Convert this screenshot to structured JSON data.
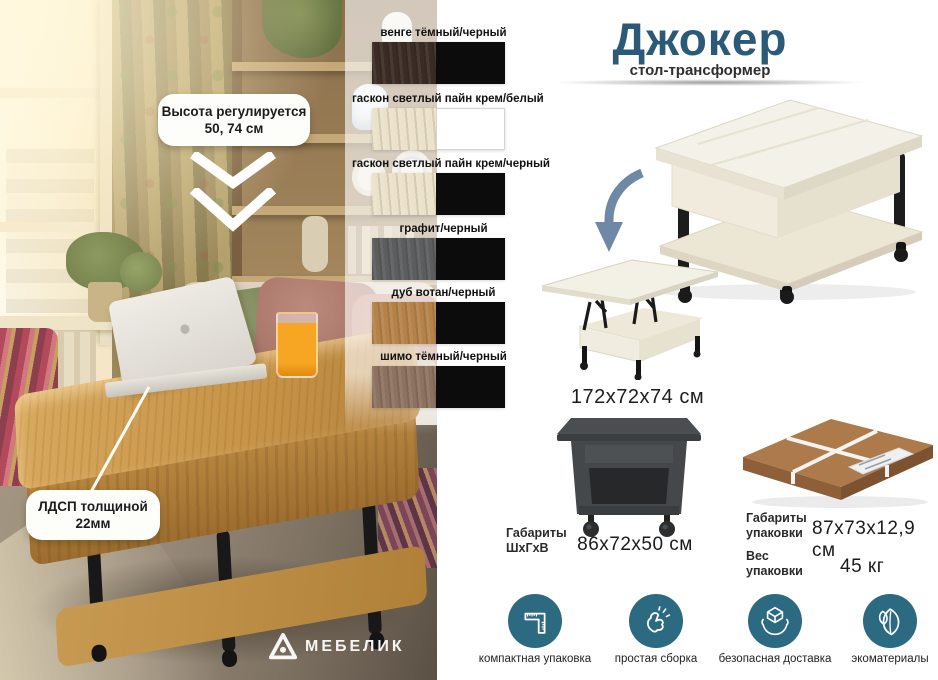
{
  "colors": {
    "accent": "#2b5a78",
    "icon_teal": "#2c6a82"
  },
  "photo": {
    "callout_height_line1": "Высота регулируется",
    "callout_height_line2": "50, 74 см",
    "callout_ldsp_line1": "ЛДСП толщиной",
    "callout_ldsp_line2": "22мм",
    "brand": "МЕБЕЛИК"
  },
  "swatches": [
    {
      "label": "венге тёмный/черный",
      "tex": "#3a2c24",
      "solid": "#0c0c0c"
    },
    {
      "label": "гаскон светлый пайн крем/белый",
      "tex": "#ece2c9",
      "solid": "#ffffff"
    },
    {
      "label": "гаскон светлый пайн крем/черный",
      "tex": "#ece2c9",
      "solid": "#0c0c0c"
    },
    {
      "label": "графит/черный",
      "tex": "#5b5d5f",
      "solid": "#0c0c0c"
    },
    {
      "label": "дуб вотан/черный",
      "tex": "#b5834a",
      "solid": "#0c0c0c"
    },
    {
      "label": "шимо тёмный/черный",
      "tex": "#8d7260",
      "solid": "#0c0c0c"
    }
  ],
  "header": {
    "title": "Джокер",
    "subtitle": "стол-трансформер"
  },
  "product": {
    "open_size": "172х72х74 см",
    "dims_label1": "Габариты",
    "dims_label2": "ШхГхВ",
    "dims_value": "86х72х50 см",
    "pack_label1": "Габариты",
    "pack_label2": "упаковки",
    "pack_value": "87х73х12,9 см",
    "weight_label1": "Вес",
    "weight_label2": "упаковки",
    "weight_value": "45 кг"
  },
  "features": [
    {
      "label": "компактная упаковка"
    },
    {
      "label": "простая сборка"
    },
    {
      "label": "безопасная доставка"
    },
    {
      "label": "экоматериалы"
    }
  ]
}
